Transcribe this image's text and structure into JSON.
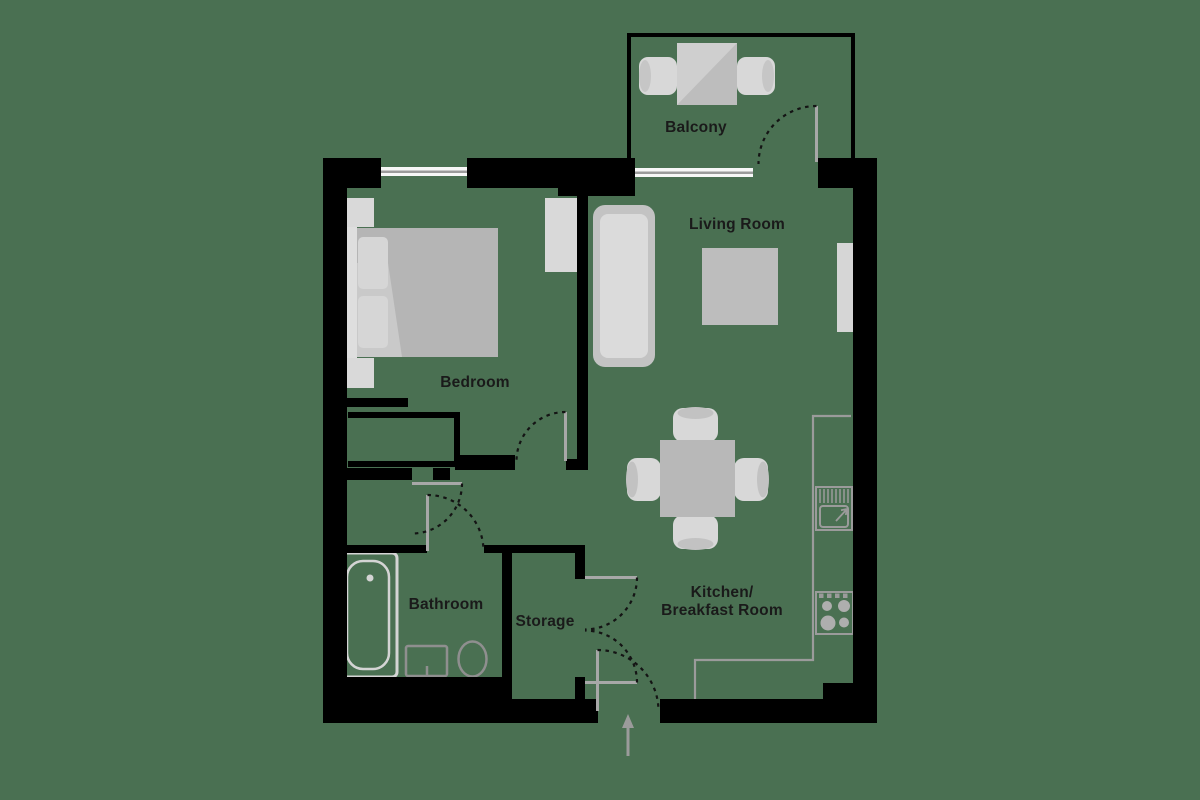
{
  "title": "Apartment floor plan",
  "colors": {
    "background": "#4a7052",
    "wall": "#000000",
    "window_glass": "#f7f7f7",
    "window_line": "#9b9b9b",
    "door_leaf": "#a8a8a8",
    "door_swing": "#141414",
    "kitchen_line": "#9b9b9b",
    "burner_fill": "#aeaeae",
    "bath_fixture_light": "#d4d4d4",
    "bath_fixture_dark": "#8f8f8f",
    "label": "#1a1a1a",
    "arrow": "#9b9b9b"
  },
  "labels": {
    "balcony": "Balcony",
    "living_room": "Living Room",
    "bedroom": "Bedroom",
    "bathroom": "Bathroom",
    "storage": "Storage",
    "kitchen_line1": "Kitchen/",
    "kitchen_line2": "Breakfast Room"
  },
  "symbols": [
    "balcony-table",
    "balcony-chair",
    "sofa",
    "coffee-table",
    "tv-unit",
    "double-bed",
    "pillow",
    "nightstand",
    "wardrobe",
    "fitted-closet",
    "dining-table",
    "dining-chair",
    "kitchen-counter",
    "kitchen-sink",
    "hob",
    "bathtub",
    "washbasin",
    "toilet",
    "door-swing",
    "window",
    "entry-arrow"
  ]
}
